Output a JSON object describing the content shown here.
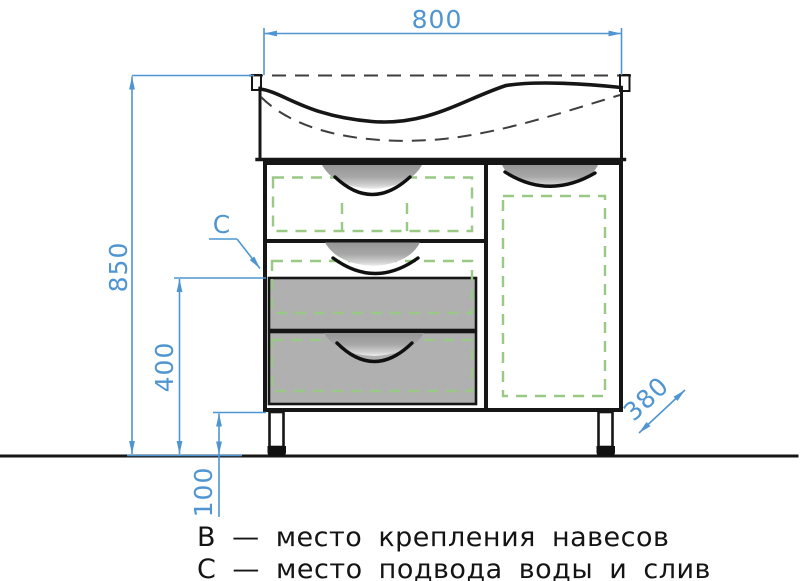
{
  "drawing": {
    "dimensions": {
      "overall_width": "800",
      "overall_height": "850",
      "drawer_section_height": "400",
      "leg_height": "100",
      "depth": "380"
    },
    "markers": {
      "water_supply": "C"
    },
    "legend": {
      "line_b": "В — место крепления навесов",
      "line_c": "С — место подвода воды и слив"
    },
    "colors": {
      "dimension_blue": "#4f95d1",
      "hatch_green": "#99c985",
      "drawer_gray": "#b0b0b0",
      "ink": "#161616"
    }
  }
}
